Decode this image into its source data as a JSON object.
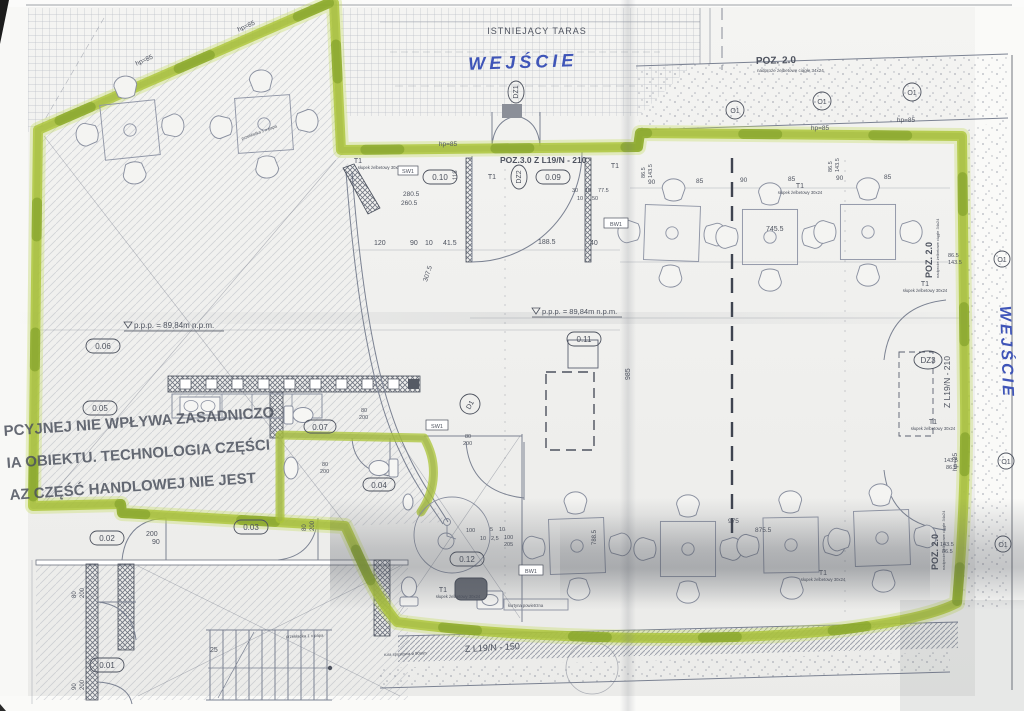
{
  "colors": {
    "highlighter": "#abc437",
    "ink": "#4d525e",
    "pen_blue": "#3f55b8"
  },
  "labels": {
    "existing_terrace": "ISTNIEJĄCY TARAS",
    "entrance_top": "WEJŚCIE",
    "entrance_right": "WEJŚCIE",
    "poz20": "POZ. 2.0",
    "poz20_note": "nadproże żelbetowe ciągłe 34x24",
    "poz30": "POZ.3.0 Z L19/N - 210",
    "lintel_right": "Z L19/N - 210",
    "lintel_bottom": "Z L19/N - 150",
    "level": "p.p.p. = 89,84m n.p.m.",
    "stamp1": "PCYJNEJ NIE WPŁYWA ZASADNICZO",
    "stamp2": "IA OBIEKTU. TECHNOLOGIA CZĘŚCI",
    "stamp3": "AZ CZĘŚĆ HANDLOWEJ NIE JEST",
    "air_curtain": "kurtyna powietrzna",
    "column_note": "słupek żelbetowy 30x24",
    "paper_note": "przekładka 1 x papa",
    "downpipe_note": "rura spustowa ø 90mm"
  },
  "rooms": {
    "r001": "0.01",
    "r002": "0.02",
    "r003": "0.03",
    "r004": "0.04",
    "r005": "0.05",
    "r006": "0.06",
    "r007": "0.07",
    "r009": "0.09",
    "r010": "0.10",
    "r011": "0.11",
    "r012": "0.12"
  },
  "marks": {
    "dz1": "DZ1",
    "dz2": "DZ2",
    "dz3": "DZ3",
    "d1": "D1",
    "t1": "T1",
    "o1": "O1",
    "sw1": "SW1",
    "bw1": "BW1",
    "hp85": "hp=85"
  },
  "dims": {
    "d745": "745.5",
    "d188": "188.5",
    "d280": "280.5",
    "d260": "260.5",
    "d307": "307.5",
    "d985": "985",
    "d975": "975",
    "d875": "875.5",
    "d788": "788.5",
    "d86": "86.5",
    "d143": "143.5",
    "d120": "120",
    "d90": "90",
    "d85": "85",
    "d40": "40",
    "d41": "41.5",
    "d10": "10",
    "d30": "30",
    "d50": "50",
    "d77": "77.5",
    "d25": "25",
    "d118": "118",
    "d200": "200",
    "d80": "80",
    "d100": "100",
    "d205": "205",
    "d5": "5",
    "d2_5": "2,5"
  }
}
